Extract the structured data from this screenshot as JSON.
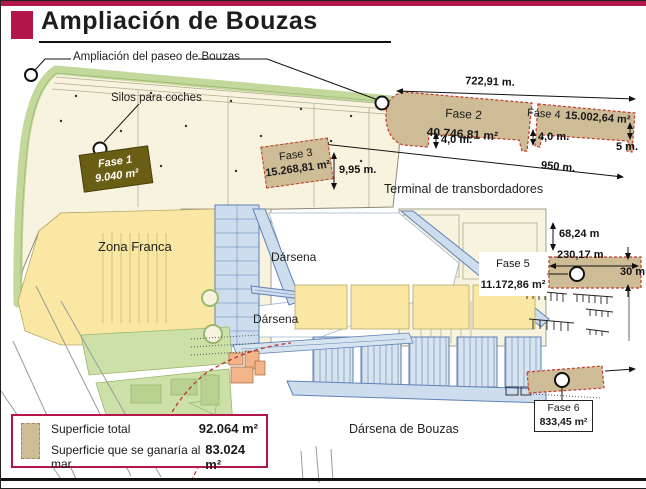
{
  "header": {
    "title": "Ampliación de Bouzas"
  },
  "labels": {
    "paseo": "Ampliación del paseo de Bouzas",
    "silos": "Silos para coches",
    "terminal": "Terminal de transbordadores",
    "zona_franca": "Zona Franca",
    "darsena_1": "Dársena",
    "darsena_2": "Dársena",
    "darsena_bouzas": "Dársena de Bouzas"
  },
  "phases": {
    "fase1": {
      "name": "Fase 1",
      "area": "9.040 m²"
    },
    "fase2": {
      "name": "Fase 2",
      "area": "40.746,81 m²"
    },
    "fase3": {
      "name": "Fase 3",
      "area": "15.268,81 m²"
    },
    "fase4": {
      "name": "Fase 4",
      "area": "15.002,64 m²"
    },
    "fase5": {
      "name": "Fase 5",
      "area": "11.172,86 m²"
    },
    "fase6": {
      "name": "Fase 6",
      "area": "833,45 m²"
    }
  },
  "measurements": {
    "m722": "722,91 m.",
    "m4a": "4,0 m.",
    "m4b": "4,0 m.",
    "m5": "5 m.",
    "m950": "950 m.",
    "m995": "9,95 m.",
    "m6824": "68,24 m",
    "m23017": "230,17 m",
    "m30": "30 m"
  },
  "legend": {
    "rows": [
      {
        "label": "Superficie total",
        "value": "92.064 m²"
      },
      {
        "label": "Superficie que se ganaría al mar",
        "value": "83.024 m²"
      }
    ]
  },
  "colors": {
    "accent_crimson": "#b3164b",
    "land_cream": "#f8f3de",
    "zone_yellow": "#fae7a3",
    "green_strip": "#c3d89b",
    "dock_blue_fill": "#cdddee",
    "dock_blue_stroke": "#5e81b5",
    "phase_tan": "#cdbc96",
    "phase_border_red": "#c03a2b",
    "fase1_olive": "#6a5e14",
    "building_orange": "#f2b488"
  }
}
